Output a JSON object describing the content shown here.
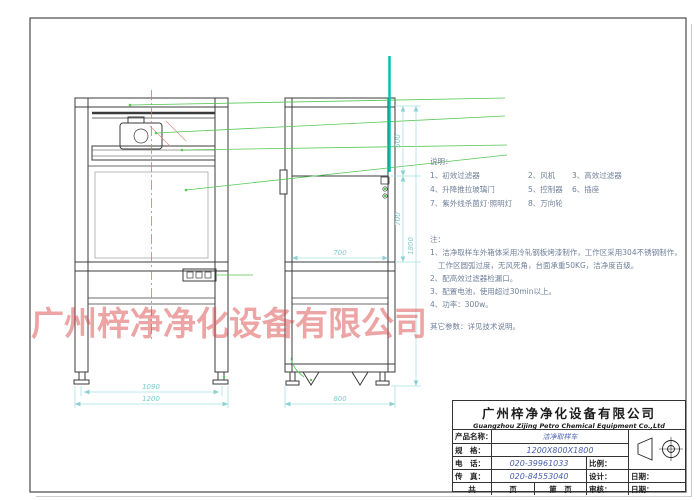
{
  "watermark": "广州梓净净化设备有限公司",
  "legend": {
    "title": "说明：",
    "rows": [
      [
        "1、初效过滤器",
        "2、风机",
        "3、高效过滤器"
      ],
      [
        "4、升降推拉玻璃门",
        "5、控制器",
        "6、插座"
      ],
      [
        "7、紫外线杀菌灯·照明灯",
        "8、万向轮",
        ""
      ]
    ]
  },
  "notes": {
    "title": "注：",
    "lines": [
      "1、洁净取样车外箱体采用冷轧钢板烤漆制作，工作区采用304不锈钢制作，",
      "工作区圆弧过度，无风死角，台面承重50KG，洁净度百级。",
      "2、配高效过滤器检漏口。",
      "3、配置电池，使用超过30min以上。",
      "4、功率：300w。"
    ],
    "footer": "其它参数：详见技术说明。"
  },
  "dimensions": {
    "front_feet_width": "1090",
    "front_width": "1200",
    "side_inner_depth": "700",
    "side_depth": "800",
    "side_top_height": "500",
    "side_opening_height": "700",
    "side_total_height": "1800"
  },
  "title_block": {
    "company_cn": "广州梓净净化设备有限公司",
    "company_en": "Guangzhou Zijing Petro Chemical Equipment Co.,Ltd",
    "product_label": "产品名称：",
    "product_value": "洁净取样车",
    "spec_label": "规　格：",
    "spec_value": "1200X800X1800",
    "tel_label": "电　话：",
    "tel_value": "020-39961033",
    "scale_label": "比例：",
    "fax_label": "传　真：",
    "fax_value": "020-84553040",
    "design_label": "设计：",
    "date_label": "日期：",
    "pages_total_label": "共",
    "pages_unit_label": "页",
    "pages_no_label": "第　页",
    "audit_label": "审核：",
    "date2_label": "日期："
  },
  "colors": {
    "dimension_cyan": "#7fc9cd",
    "leader_green": "#55c855",
    "teal_line": "#00c4b0",
    "centerline_red": "#e07070",
    "watermark_red": "#d94a4a",
    "value_blue": "#4a5fb0"
  }
}
